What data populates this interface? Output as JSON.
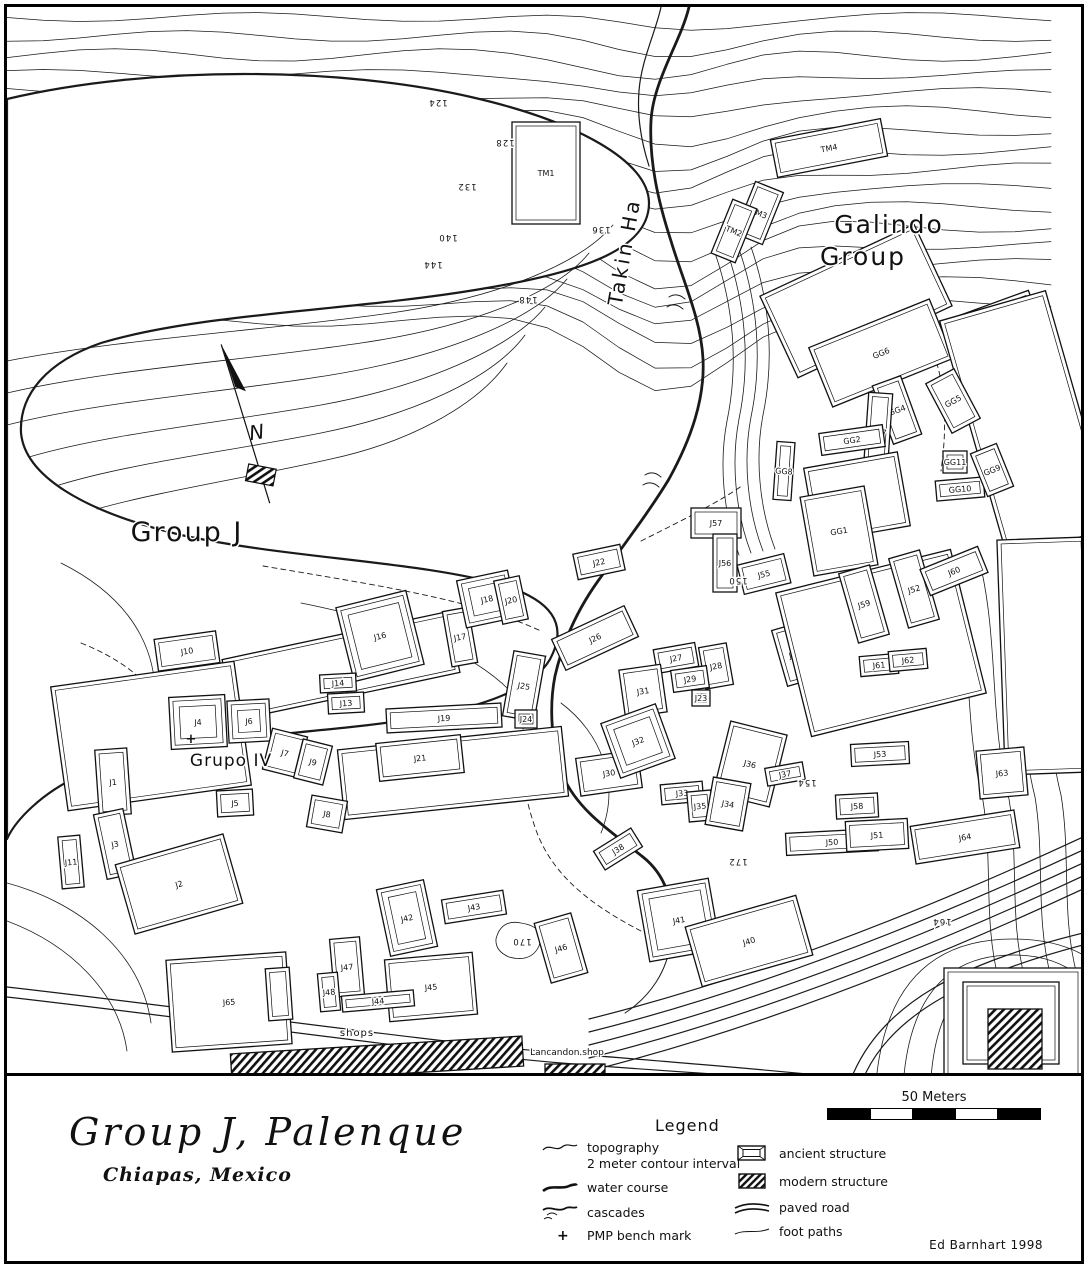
{
  "title": {
    "main": "Group J,  Palenque",
    "sub": "Chiapas, Mexico"
  },
  "credit": "Ed Barnhart 1998",
  "scale_bar": {
    "label": "50 Meters"
  },
  "legend": {
    "heading": "Legend",
    "left": [
      {
        "icon": "contour-line-icon",
        "label": "topography",
        "sublabel": "2 meter contour interval"
      },
      {
        "icon": "water-course-icon",
        "label": "water course",
        "sublabel": ""
      },
      {
        "icon": "cascades-icon",
        "label": "cascades",
        "sublabel": ""
      },
      {
        "icon": "bench-mark-icon",
        "label": "PMP bench mark",
        "sublabel": ""
      }
    ],
    "right": [
      {
        "icon": "ancient-structure-icon",
        "label": "ancient structure"
      },
      {
        "icon": "modern-structure-icon",
        "label": "modern structure"
      },
      {
        "icon": "paved-road-icon",
        "label": "paved road"
      },
      {
        "icon": "foot-paths-icon",
        "label": "foot paths"
      }
    ]
  },
  "map": {
    "north": {
      "label": "N"
    },
    "place_labels": [
      {
        "id": "takin-ha",
        "t": "Takin Ha",
        "x": 630,
        "y": 252,
        "s": 20,
        "r": -80,
        "ls": 3
      },
      {
        "id": "galindo-group-line1",
        "t": "Galindo",
        "x": 888,
        "y": 232,
        "s": 25,
        "r": 0,
        "ls": 2
      },
      {
        "id": "galindo-group-line2",
        "t": "Group",
        "x": 862,
        "y": 264,
        "s": 25,
        "r": 0,
        "ls": 2
      },
      {
        "id": "group-j",
        "t": "Group J",
        "x": 186,
        "y": 540,
        "s": 27,
        "r": 0,
        "ls": 2
      },
      {
        "id": "grupo-iv",
        "t": "Grupo IV",
        "x": 230,
        "y": 765,
        "s": 17,
        "r": 0,
        "ls": 1
      },
      {
        "id": "shops",
        "t": "shops",
        "x": 356,
        "y": 1035,
        "s": 10,
        "r": 0,
        "ls": 1
      },
      {
        "id": "lancandon-shop",
        "t": "Lancandon shop",
        "x": 566,
        "y": 1054,
        "s": 9,
        "r": 0,
        "ls": 0
      }
    ],
    "contour_labels": [
      {
        "t": "124",
        "x": 437,
        "y": 99
      },
      {
        "t": "128",
        "x": 504,
        "y": 139
      },
      {
        "t": "132",
        "x": 466,
        "y": 183
      },
      {
        "t": "136",
        "x": 600,
        "y": 226
      },
      {
        "t": "140",
        "x": 447,
        "y": 234
      },
      {
        "t": "144",
        "x": 432,
        "y": 261
      },
      {
        "t": "148",
        "x": 527,
        "y": 296
      },
      {
        "t": "150",
        "x": 737,
        "y": 577
      },
      {
        "t": "154",
        "x": 806,
        "y": 779
      },
      {
        "t": "172",
        "x": 737,
        "y": 858
      },
      {
        "t": "170",
        "x": 521,
        "y": 938
      },
      {
        "t": "164",
        "x": 941,
        "y": 918
      }
    ],
    "bench_marks": [
      {
        "x": 190,
        "y": 742
      }
    ],
    "structures": [
      {
        "l": "",
        "x": 855,
        "y": 300,
        "w": 170,
        "h": 90,
        "r": -25,
        "k": "a"
      },
      {
        "l": "GG6",
        "x": 880,
        "y": 352,
        "w": 130,
        "h": 64,
        "r": -22,
        "k": "a"
      },
      {
        "l": "",
        "x": 995,
        "y": 332,
        "w": 90,
        "h": 58,
        "r": -20,
        "k": "a"
      },
      {
        "l": "",
        "x": 1026,
        "y": 425,
        "w": 110,
        "h": 250,
        "r": -16,
        "k": "a"
      },
      {
        "l": "",
        "x": 1044,
        "y": 655,
        "w": 88,
        "h": 235,
        "r": -2,
        "k": "a"
      },
      {
        "l": "GG4",
        "x": 896,
        "y": 409,
        "w": 30,
        "h": 62,
        "r": -20,
        "k": "a"
      },
      {
        "l": "GG5",
        "x": 952,
        "y": 400,
        "w": 32,
        "h": 56,
        "r": -28,
        "k": "a"
      },
      {
        "l": "GG7",
        "x": 877,
        "y": 431,
        "w": 24,
        "h": 78,
        "r": 4,
        "k": "a"
      },
      {
        "l": "GG2",
        "x": 851,
        "y": 439,
        "w": 64,
        "h": 22,
        "r": -8,
        "k": "a"
      },
      {
        "l": "GG8",
        "x": 783,
        "y": 470,
        "w": 18,
        "h": 58,
        "r": 4,
        "k": "a"
      },
      {
        "l": "GG11",
        "x": 954,
        "y": 461,
        "w": 24,
        "h": 22,
        "r": 0,
        "k": "a"
      },
      {
        "l": "GG10",
        "x": 959,
        "y": 488,
        "w": 48,
        "h": 20,
        "r": -5,
        "k": "a"
      },
      {
        "l": "GG9",
        "x": 991,
        "y": 469,
        "w": 28,
        "h": 46,
        "r": -22,
        "k": "a"
      },
      {
        "l": "GG3",
        "x": 856,
        "y": 496,
        "w": 95,
        "h": 75,
        "r": -10,
        "k": "a"
      },
      {
        "l": "GG1",
        "x": 838,
        "y": 530,
        "w": 65,
        "h": 80,
        "r": -10,
        "k": "a"
      },
      {
        "l": "TM1",
        "x": 545,
        "y": 172,
        "w": 68,
        "h": 102,
        "r": 0,
        "k": "a"
      },
      {
        "l": "TM4",
        "x": 828,
        "y": 147,
        "w": 112,
        "h": 38,
        "r": -11,
        "k": "a"
      },
      {
        "l": "TM3",
        "x": 758,
        "y": 212,
        "w": 30,
        "h": 56,
        "r": 22,
        "k": "a"
      },
      {
        "l": "TM2",
        "x": 733,
        "y": 230,
        "w": 26,
        "h": 58,
        "r": 22,
        "k": "a"
      },
      {
        "l": "J57",
        "x": 715,
        "y": 522,
        "w": 50,
        "h": 30,
        "r": 0,
        "k": "a"
      },
      {
        "l": "J56",
        "x": 724,
        "y": 562,
        "w": 24,
        "h": 58,
        "r": 0,
        "k": "a"
      },
      {
        "l": "J55",
        "x": 763,
        "y": 573,
        "w": 48,
        "h": 30,
        "r": -14,
        "k": "a"
      },
      {
        "l": "J22",
        "x": 598,
        "y": 561,
        "w": 48,
        "h": 26,
        "r": -12,
        "k": "a"
      },
      {
        "l": "J26",
        "x": 594,
        "y": 637,
        "w": 80,
        "h": 34,
        "r": -25,
        "k": "a"
      },
      {
        "l": "J27",
        "x": 675,
        "y": 657,
        "w": 42,
        "h": 24,
        "r": -10,
        "k": "a"
      },
      {
        "l": "J28",
        "x": 715,
        "y": 665,
        "w": 28,
        "h": 42,
        "r": -10,
        "k": "a"
      },
      {
        "l": "J29",
        "x": 689,
        "y": 678,
        "w": 36,
        "h": 22,
        "r": -8,
        "k": "a"
      },
      {
        "l": "J31",
        "x": 642,
        "y": 690,
        "w": 42,
        "h": 48,
        "r": -8,
        "k": "a"
      },
      {
        "l": "J23",
        "x": 700,
        "y": 697,
        "w": 18,
        "h": 16,
        "r": 0,
        "k": "a"
      },
      {
        "l": "J54",
        "x": 794,
        "y": 653,
        "w": 32,
        "h": 58,
        "r": -16,
        "k": "a"
      },
      {
        "l": "",
        "x": 880,
        "y": 642,
        "w": 180,
        "h": 148,
        "r": -14,
        "k": "a"
      },
      {
        "l": "J59",
        "x": 863,
        "y": 603,
        "w": 32,
        "h": 72,
        "r": -16,
        "k": "a"
      },
      {
        "l": "J52",
        "x": 913,
        "y": 588,
        "w": 32,
        "h": 72,
        "r": -16,
        "k": "a"
      },
      {
        "l": "J60",
        "x": 953,
        "y": 570,
        "w": 62,
        "h": 28,
        "r": -22,
        "k": "a"
      },
      {
        "l": "J61",
        "x": 878,
        "y": 664,
        "w": 38,
        "h": 20,
        "r": -5,
        "k": "a"
      },
      {
        "l": "J62",
        "x": 907,
        "y": 659,
        "w": 38,
        "h": 20,
        "r": -5,
        "k": "a"
      },
      {
        "l": "J63",
        "x": 1001,
        "y": 772,
        "w": 48,
        "h": 48,
        "r": -5,
        "k": "a"
      },
      {
        "l": "J64",
        "x": 964,
        "y": 836,
        "w": 105,
        "h": 38,
        "r": -9,
        "k": "a"
      },
      {
        "l": "J53",
        "x": 879,
        "y": 753,
        "w": 58,
        "h": 22,
        "r": -3,
        "k": "a"
      },
      {
        "l": "J58",
        "x": 856,
        "y": 805,
        "w": 42,
        "h": 24,
        "r": -3,
        "k": "a"
      },
      {
        "l": "J50",
        "x": 831,
        "y": 841,
        "w": 92,
        "h": 22,
        "r": -3,
        "k": "a"
      },
      {
        "l": "J51",
        "x": 876,
        "y": 834,
        "w": 62,
        "h": 30,
        "r": -3,
        "k": "a"
      },
      {
        "l": "J30",
        "x": 608,
        "y": 772,
        "w": 62,
        "h": 38,
        "r": -8,
        "k": "a"
      },
      {
        "l": "J38",
        "x": 617,
        "y": 848,
        "w": 44,
        "h": 22,
        "r": -32,
        "k": "a"
      },
      {
        "l": "J32",
        "x": 637,
        "y": 740,
        "w": 58,
        "h": 58,
        "r": -20,
        "k": "p"
      },
      {
        "l": "J36",
        "x": 749,
        "y": 763,
        "w": 58,
        "h": 74,
        "r": 14,
        "k": "a"
      },
      {
        "l": "J37",
        "x": 784,
        "y": 773,
        "w": 38,
        "h": 18,
        "r": -10,
        "k": "a"
      },
      {
        "l": "J33",
        "x": 681,
        "y": 792,
        "w": 42,
        "h": 20,
        "r": -5,
        "k": "a"
      },
      {
        "l": "J35",
        "x": 699,
        "y": 805,
        "w": 24,
        "h": 30,
        "r": -5,
        "k": "a"
      },
      {
        "l": "J34",
        "x": 727,
        "y": 803,
        "w": 38,
        "h": 48,
        "r": 10,
        "k": "a"
      },
      {
        "l": "J41",
        "x": 678,
        "y": 919,
        "w": 72,
        "h": 72,
        "r": -10,
        "k": "p"
      },
      {
        "l": "J40",
        "x": 748,
        "y": 940,
        "w": 115,
        "h": 62,
        "r": -16,
        "k": "a"
      },
      {
        "l": "J42",
        "x": 406,
        "y": 917,
        "w": 48,
        "h": 68,
        "r": -12,
        "k": "p"
      },
      {
        "l": "J43",
        "x": 473,
        "y": 906,
        "w": 62,
        "h": 24,
        "r": -9,
        "k": "a"
      },
      {
        "l": "J46",
        "x": 560,
        "y": 947,
        "w": 38,
        "h": 62,
        "r": -16,
        "k": "a"
      },
      {
        "l": "J47",
        "x": 346,
        "y": 966,
        "w": 30,
        "h": 58,
        "r": -5,
        "k": "a"
      },
      {
        "l": "J48",
        "x": 328,
        "y": 991,
        "w": 20,
        "h": 38,
        "r": -5,
        "k": "a"
      },
      {
        "l": "J45",
        "x": 430,
        "y": 986,
        "w": 88,
        "h": 62,
        "r": -5,
        "k": "a"
      },
      {
        "l": "J44",
        "x": 377,
        "y": 1000,
        "w": 72,
        "h": 16,
        "r": -5,
        "k": "a"
      },
      {
        "l": "",
        "x": 340,
        "y": 665,
        "w": 230,
        "h": 62,
        "r": -12,
        "k": "a"
      },
      {
        "l": "",
        "x": 150,
        "y": 735,
        "w": 185,
        "h": 125,
        "r": -8,
        "k": "a"
      },
      {
        "l": "",
        "x": 452,
        "y": 772,
        "w": 225,
        "h": 70,
        "r": -6,
        "k": "a"
      },
      {
        "l": "J10",
        "x": 186,
        "y": 650,
        "w": 62,
        "h": 32,
        "r": -8,
        "k": "a"
      },
      {
        "l": "J16",
        "x": 379,
        "y": 635,
        "w": 72,
        "h": 76,
        "r": -14,
        "k": "p"
      },
      {
        "l": "J17",
        "x": 459,
        "y": 636,
        "w": 26,
        "h": 56,
        "r": -10,
        "k": "a"
      },
      {
        "l": "J18",
        "x": 486,
        "y": 598,
        "w": 52,
        "h": 48,
        "r": -12,
        "k": "p"
      },
      {
        "l": "J20",
        "x": 510,
        "y": 599,
        "w": 26,
        "h": 44,
        "r": -12,
        "k": "a"
      },
      {
        "l": "J14",
        "x": 337,
        "y": 682,
        "w": 36,
        "h": 18,
        "r": -3,
        "k": "a"
      },
      {
        "l": "J13",
        "x": 345,
        "y": 702,
        "w": 36,
        "h": 20,
        "r": -3,
        "k": "a"
      },
      {
        "l": "J25",
        "x": 523,
        "y": 685,
        "w": 32,
        "h": 66,
        "r": 10,
        "k": "a"
      },
      {
        "l": "J24",
        "x": 525,
        "y": 718,
        "w": 22,
        "h": 18,
        "r": 0,
        "k": "a"
      },
      {
        "l": "J19",
        "x": 443,
        "y": 717,
        "w": 115,
        "h": 24,
        "r": -3,
        "k": "a"
      },
      {
        "l": "J21",
        "x": 419,
        "y": 757,
        "w": 85,
        "h": 38,
        "r": -6,
        "k": "a"
      },
      {
        "l": "J4",
        "x": 197,
        "y": 721,
        "w": 56,
        "h": 52,
        "r": -3,
        "k": "p"
      },
      {
        "l": "J6",
        "x": 248,
        "y": 720,
        "w": 42,
        "h": 42,
        "r": -3,
        "k": "p"
      },
      {
        "l": "J7",
        "x": 284,
        "y": 752,
        "w": 36,
        "h": 42,
        "r": 14,
        "k": "a"
      },
      {
        "l": "J9",
        "x": 312,
        "y": 761,
        "w": 30,
        "h": 40,
        "r": 14,
        "k": "a"
      },
      {
        "l": "J5",
        "x": 234,
        "y": 802,
        "w": 36,
        "h": 26,
        "r": -3,
        "k": "a"
      },
      {
        "l": "J8",
        "x": 326,
        "y": 813,
        "w": 36,
        "h": 32,
        "r": 10,
        "k": "a"
      },
      {
        "l": "J1",
        "x": 112,
        "y": 781,
        "w": 32,
        "h": 66,
        "r": -4,
        "k": "a"
      },
      {
        "l": "J3",
        "x": 114,
        "y": 843,
        "w": 30,
        "h": 66,
        "r": -12,
        "k": "a"
      },
      {
        "l": "J2",
        "x": 178,
        "y": 883,
        "w": 112,
        "h": 72,
        "r": -16,
        "k": "a"
      },
      {
        "l": "J11",
        "x": 70,
        "y": 861,
        "w": 22,
        "h": 52,
        "r": -5,
        "k": "a"
      },
      {
        "l": "J65",
        "x": 228,
        "y": 1001,
        "w": 120,
        "h": 92,
        "r": -4,
        "k": "a"
      },
      {
        "l": "",
        "x": 278,
        "y": 993,
        "w": 24,
        "h": 52,
        "r": -4,
        "k": "a"
      },
      {
        "l": "",
        "x": 1012,
        "y": 1022,
        "w": 138,
        "h": 110,
        "r": 0,
        "k": "a"
      },
      {
        "l": "",
        "x": 1010,
        "y": 1022,
        "w": 96,
        "h": 82,
        "r": 0,
        "k": "a"
      },
      {
        "l": "",
        "x": 376,
        "y": 1059,
        "w": 292,
        "h": 30,
        "r": -3.5,
        "k": "m"
      },
      {
        "l": "",
        "x": 574,
        "y": 1072,
        "w": 60,
        "h": 18,
        "r": 0,
        "k": "m"
      },
      {
        "l": "",
        "x": 1014,
        "y": 1038,
        "w": 54,
        "h": 60,
        "r": 0,
        "k": "m"
      }
    ]
  }
}
